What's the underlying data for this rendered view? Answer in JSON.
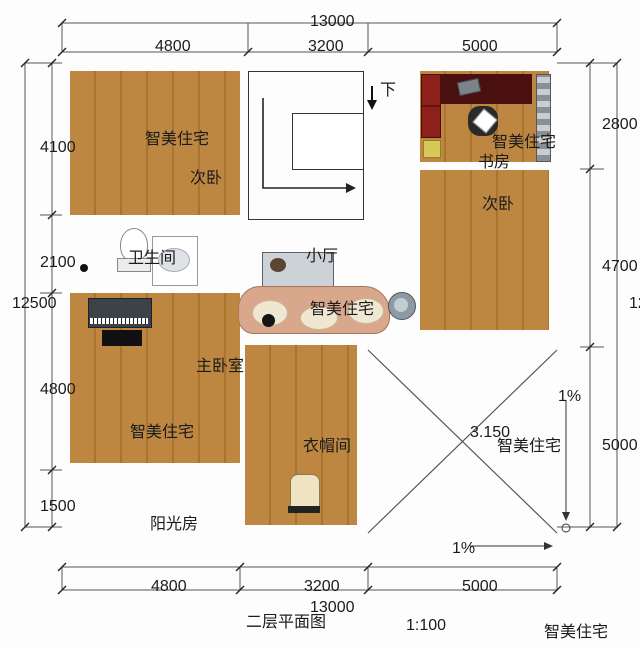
{
  "title": {
    "text": "二层平面图",
    "scale": "1:100"
  },
  "brand": {
    "text": "智美住宅"
  },
  "watermark": "智美住宅",
  "dimensions": {
    "top": {
      "total": "13000",
      "segments": [
        "4800",
        "3200",
        "5000"
      ]
    },
    "bottom": {
      "total": "13000",
      "segments": [
        "4800",
        "3200",
        "5000"
      ]
    },
    "left": {
      "total": "12500",
      "segments": [
        "4100",
        "2100",
        "4800",
        "1500"
      ]
    },
    "right": {
      "total": "12500",
      "segments": [
        "2800",
        "4700",
        "5000"
      ]
    }
  },
  "rooms": {
    "bedroom2_left": "次卧",
    "study": "书房",
    "bedroom2_right": "次卧",
    "bathroom": "卫生间",
    "hall": "小厅",
    "master": "主卧室",
    "cloakroom": "衣帽间",
    "sunroom": "阳光房"
  },
  "stairs": {
    "down": "下"
  },
  "roof": {
    "elevation": "3.150",
    "slope_right": "1%",
    "slope_bottom": "1%"
  }
}
